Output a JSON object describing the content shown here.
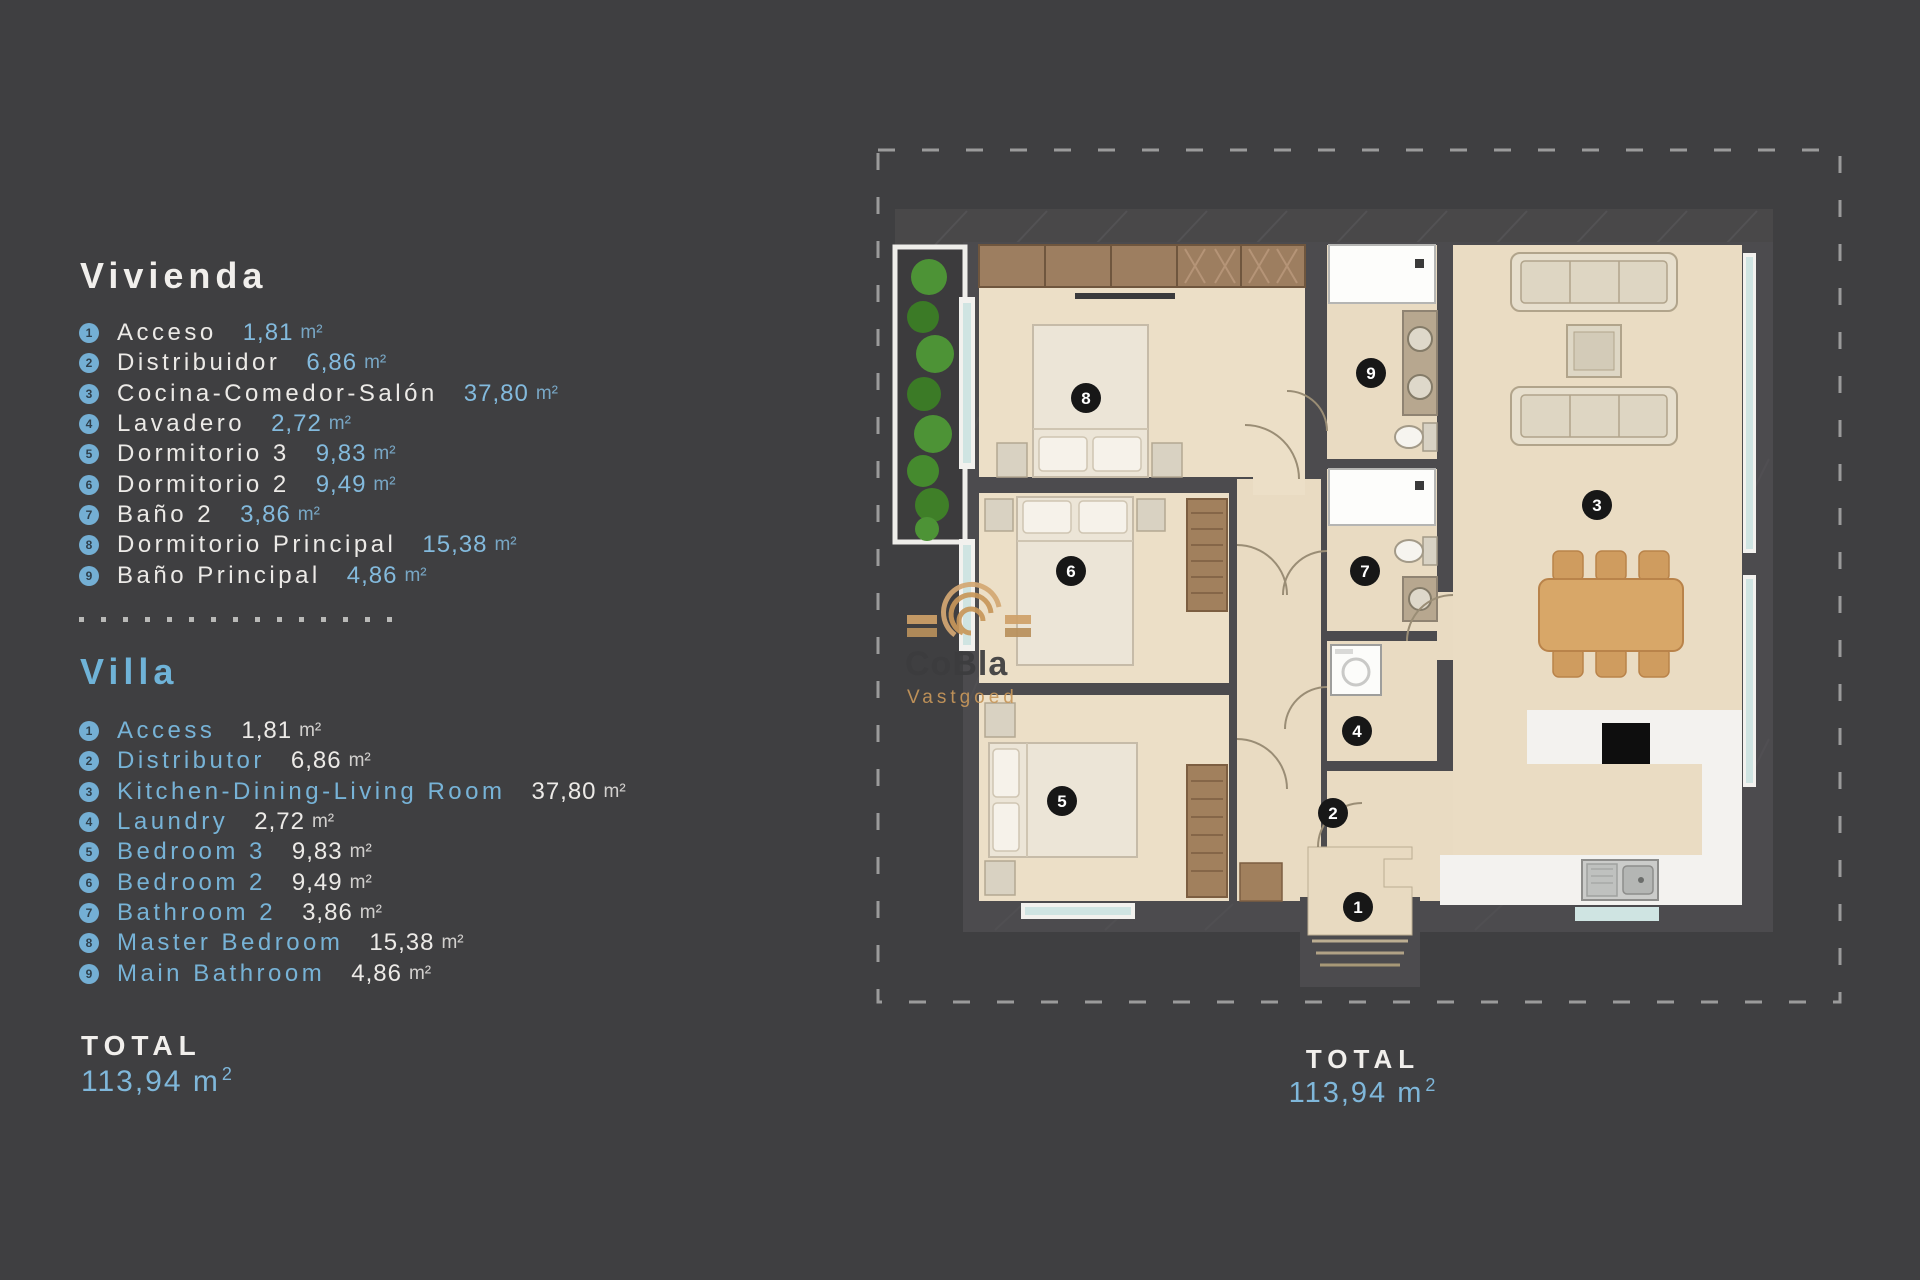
{
  "colors": {
    "background": "#3f3f41",
    "accent_blue": "#74afd4",
    "text_white": "#efedea",
    "floor_beige": "#ebdec6",
    "wall_gray": "#4c4b4e",
    "wood_brown": "#9d7e60",
    "table_wood": "#d8a768",
    "plant_green": "#4d9336",
    "window_teal": "#cfe4e2",
    "counter_white": "#f3f2ef",
    "marker_black": "#171717"
  },
  "legend_es": {
    "title": "Vivienda",
    "items": [
      {
        "num": "1",
        "name": "Acceso",
        "area": "1,81",
        "unit": "m²"
      },
      {
        "num": "2",
        "name": "Distribuidor",
        "area": "6,86",
        "unit": "m²"
      },
      {
        "num": "3",
        "name": "Cocina-Comedor-Salón",
        "area": "37,80",
        "unit": "m²"
      },
      {
        "num": "4",
        "name": "Lavadero",
        "area": "2,72",
        "unit": "m²"
      },
      {
        "num": "5",
        "name": "Dormitorio 3",
        "area": "9,83",
        "unit": "m²"
      },
      {
        "num": "6",
        "name": "Dormitorio 2",
        "area": "9,49",
        "unit": "m²"
      },
      {
        "num": "7",
        "name": "Baño 2",
        "area": "3,86",
        "unit": "m²"
      },
      {
        "num": "8",
        "name": "Dormitorio Principal",
        "area": "15,38",
        "unit": "m²"
      },
      {
        "num": "9",
        "name": "Baño Principal",
        "area": "4,86",
        "unit": "m²"
      }
    ]
  },
  "legend_en": {
    "title": "Villa",
    "items": [
      {
        "num": "1",
        "name": "Access",
        "area": "1,81",
        "unit": "m²"
      },
      {
        "num": "2",
        "name": "Distributor",
        "area": "6,86",
        "unit": "m²"
      },
      {
        "num": "3",
        "name": "Kitchen-Dining-Living Room",
        "area": "37,80",
        "unit": "m²"
      },
      {
        "num": "4",
        "name": "Laundry",
        "area": "2,72",
        "unit": "m²"
      },
      {
        "num": "5",
        "name": "Bedroom 3",
        "area": "9,83",
        "unit": "m²"
      },
      {
        "num": "6",
        "name": "Bedroom 2",
        "area": "9,49",
        "unit": "m²"
      },
      {
        "num": "7",
        "name": "Bathroom 2",
        "area": "3,86",
        "unit": "m²"
      },
      {
        "num": "8",
        "name": "Master Bedroom",
        "area": "15,38",
        "unit": "m²"
      },
      {
        "num": "9",
        "name": "Main Bathroom",
        "area": "4,86",
        "unit": "m²"
      }
    ]
  },
  "total_left": {
    "label": "TOTAL",
    "value": "113,94 m",
    "sup": "2"
  },
  "total_plan": {
    "label": "TOTAL",
    "value": "113,94 m",
    "sup": "2"
  },
  "watermark": {
    "brand": "CoBla",
    "sub": "Vastgoed"
  },
  "plan": {
    "markers": [
      "1",
      "2",
      "3",
      "4",
      "5",
      "6",
      "7",
      "8",
      "9"
    ]
  }
}
